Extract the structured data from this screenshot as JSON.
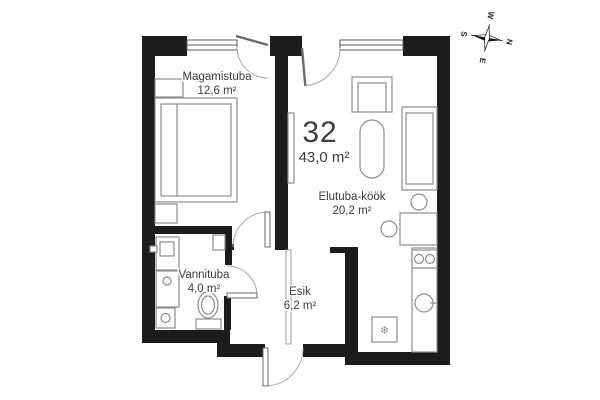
{
  "unit": {
    "number": "32",
    "total_area": "43,0 m²"
  },
  "rooms": [
    {
      "name": "Magamistuba",
      "area": "12,6 m²"
    },
    {
      "name": "Elutuba-köök",
      "area": "20,2 m²"
    },
    {
      "name": "Vannituba",
      "area": "4,0 m²"
    },
    {
      "name": "Esik",
      "area": "6,2 m²"
    }
  ],
  "compass": {
    "north": "N",
    "east": "E",
    "south": "S",
    "west": "W"
  },
  "icons": {
    "fridge_snowflake": "❄"
  },
  "fixtures": [
    "bed",
    "nightstand",
    "armchair",
    "dining-table",
    "sofa",
    "kitchen-table",
    "chair",
    "cooktop",
    "sink",
    "fridge",
    "washbasin",
    "washing-machine",
    "toilet",
    "tv-bench"
  ],
  "colors": {
    "wall": "#1c1c1c",
    "furniture_line": "#8c8c8c",
    "text": "#3d3d3d",
    "background": "#ffffff"
  }
}
